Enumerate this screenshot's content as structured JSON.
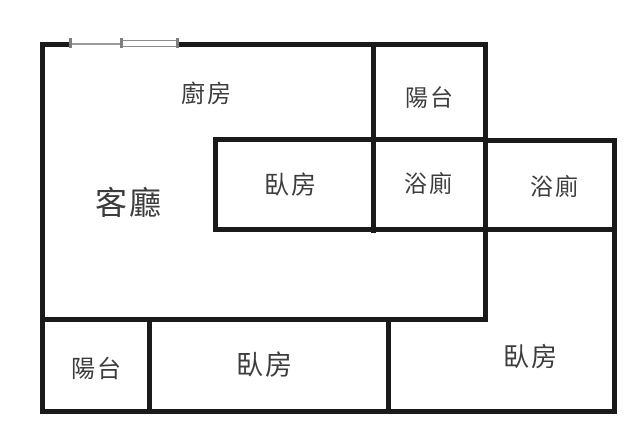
{
  "title": "apartment-floor-plan",
  "canvas": {
    "width": 640,
    "height": 439,
    "background": "#ffffff"
  },
  "style": {
    "wall_color": "#1a1a1a",
    "window_color": "#8c8c8c",
    "label_color": "#3d3d3d"
  },
  "rooms": [
    {
      "name": "kitchen",
      "label": "廚房",
      "cx": 207,
      "cy": 95,
      "font_size": 24
    },
    {
      "name": "balcony-top",
      "label": "陽台",
      "cx": 430,
      "cy": 98,
      "font_size": 23
    },
    {
      "name": "bedroom-top-middle",
      "label": "臥房",
      "cx": 291,
      "cy": 186,
      "font_size": 25
    },
    {
      "name": "bathroom-left",
      "label": "浴廁",
      "cx": 429,
      "cy": 184,
      "font_size": 23
    },
    {
      "name": "bathroom-right",
      "label": "浴廁",
      "cx": 555,
      "cy": 187,
      "font_size": 23
    },
    {
      "name": "living-room",
      "label": "客廳",
      "cx": 129,
      "cy": 203,
      "font_size": 32
    },
    {
      "name": "balcony-bottom",
      "label": "陽台",
      "cx": 97,
      "cy": 370,
      "font_size": 24
    },
    {
      "name": "bedroom-bottom-middle",
      "label": "臥房",
      "cx": 265,
      "cy": 366,
      "font_size": 27
    },
    {
      "name": "bedroom-bottom-right",
      "label": "臥房",
      "cx": 531,
      "cy": 358,
      "font_size": 26
    }
  ],
  "walls": [
    {
      "name": "top-wall-left-segment",
      "x": 40,
      "y": 42,
      "w": 32,
      "h": 5
    },
    {
      "name": "top-wall-right-segment",
      "x": 176,
      "y": 42,
      "w": 312,
      "h": 5
    },
    {
      "name": "left-wall",
      "x": 40,
      "y": 42,
      "w": 5,
      "h": 372
    },
    {
      "name": "bottom-wall",
      "x": 40,
      "y": 409,
      "w": 577,
      "h": 5
    },
    {
      "name": "right-wall",
      "x": 612,
      "y": 138,
      "w": 5,
      "h": 276
    },
    {
      "name": "bathroom-right-top-wall",
      "x": 483,
      "y": 138,
      "w": 134,
      "h": 5
    },
    {
      "name": "balcony-bathroom-vertical-wall",
      "x": 483,
      "y": 42,
      "w": 5,
      "h": 280
    },
    {
      "name": "kitchen-balcony-vertical-wall",
      "x": 371,
      "y": 42,
      "w": 5,
      "h": 191
    },
    {
      "name": "bedroom-top-top-wall",
      "x": 213,
      "y": 137,
      "w": 275,
      "h": 5
    },
    {
      "name": "bedroom-top-left-wall",
      "x": 213,
      "y": 137,
      "w": 5,
      "h": 95
    },
    {
      "name": "rooms-bottom-horizontal-wall",
      "x": 213,
      "y": 227,
      "w": 404,
      "h": 5
    },
    {
      "name": "living-bottom-horizontal-wall",
      "x": 40,
      "y": 317,
      "w": 448,
      "h": 5
    },
    {
      "name": "balcony-bedroom-vertical-wall",
      "x": 147,
      "y": 317,
      "w": 5,
      "h": 97
    },
    {
      "name": "bedroom-bedroom-vertical-wall",
      "x": 386,
      "y": 317,
      "w": 5,
      "h": 97
    }
  ],
  "window": {
    "rail": {
      "x": 70,
      "y": 43,
      "w": 108,
      "h": 2
    },
    "pane": {
      "x": 121,
      "y": 40,
      "w": 57,
      "h": 7
    },
    "ticks": [
      {
        "x": 69,
        "y": 38,
        "w": 3,
        "h": 10
      },
      {
        "x": 120,
        "y": 38,
        "w": 3,
        "h": 10
      },
      {
        "x": 176,
        "y": 38,
        "w": 3,
        "h": 10
      }
    ]
  }
}
